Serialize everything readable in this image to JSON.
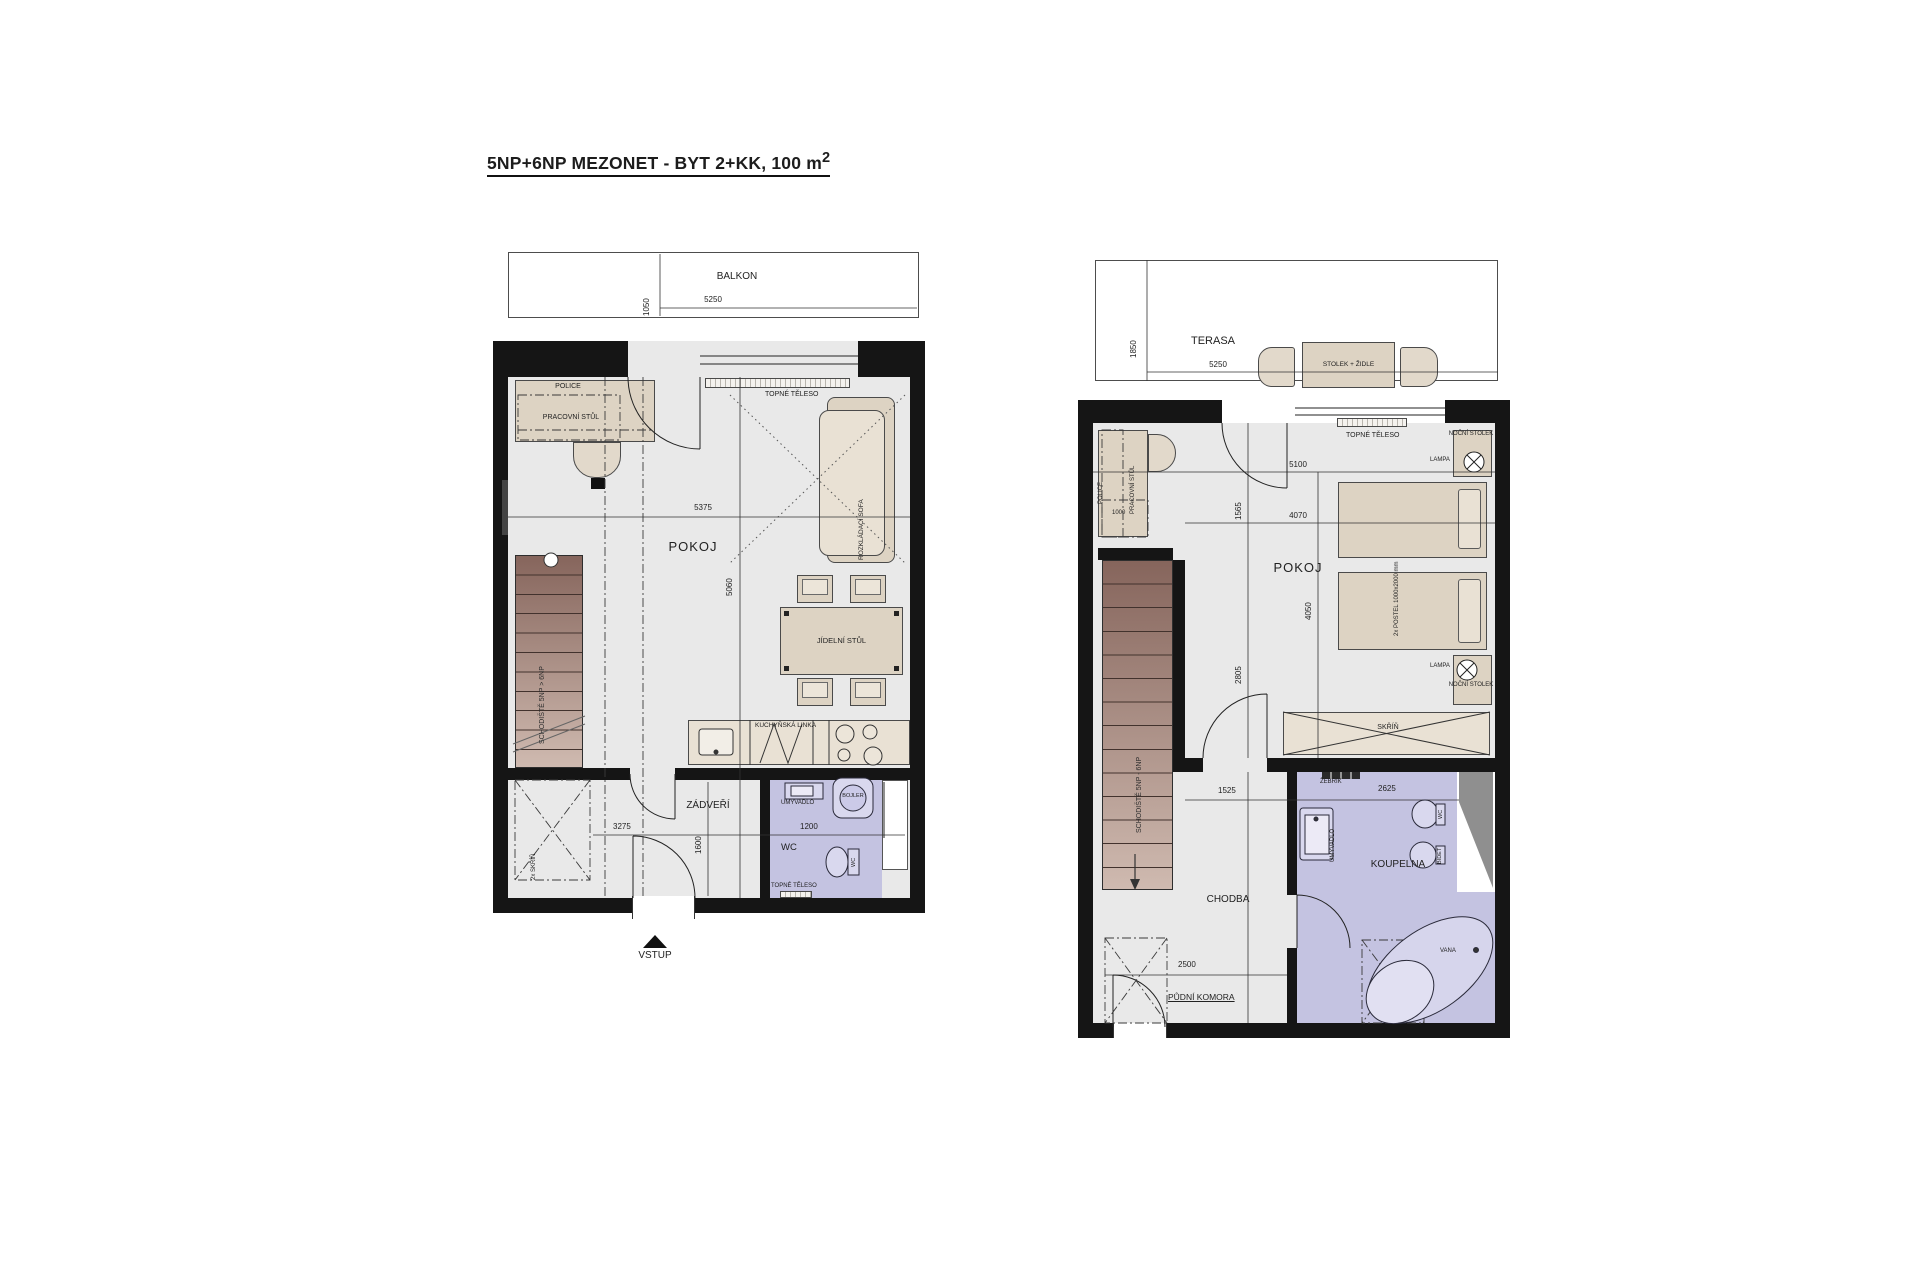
{
  "title": "5NP+6NP MEZONET - BYT 2+KK, 100 m",
  "title_sup": "2",
  "p5": {
    "balkon": "BALKON",
    "d1050": "1050",
    "d5250": "5250",
    "police": "POLICE",
    "stul": "PRACOVNÍ STŮL",
    "topne": "TOPNÉ TĚLESO",
    "sofa": "ROZKLÁDACÍ SOFA",
    "pokoj": "POKOJ",
    "d5375": "5375",
    "d5060": "5060",
    "jidelni": "JÍDELNÍ STŮL",
    "kuchyn": "KUCHYŇSKÁ LINKA",
    "schodiste": "SCHODIŠTĚ 5NP > 6NP",
    "zadveri": "ZÁDVEŘÍ",
    "d3275": "3275",
    "d1600": "1600",
    "skrin": "2x SKŘÍŇ",
    "wc": "WC",
    "d1200": "1200",
    "umyvadlo": "UMYVADLO",
    "bojler": "BOJLER",
    "wc2": "WC",
    "topne2": "TOPNÉ TĚLESO",
    "vstup": "VSTUP"
  },
  "p6": {
    "terasa": "TERASA",
    "d1850": "1850",
    "d5250": "5250",
    "stolek": "STOLEK + ŽIDLE",
    "police": "POLICE",
    "stul": "PRACOVNÍ STŮL",
    "d1000": "1000",
    "topne": "TOPNÉ TĚLESO",
    "nocni1": "NOČNÍ STOLEK",
    "lampa1": "LAMPA",
    "d5100": "5100",
    "d1565": "1565",
    "d4070": "4070",
    "d4050": "4050",
    "d2805": "2805",
    "pokoj": "POKOJ",
    "postel": "2x POSTEL 1000x2000 mm",
    "lampa2": "LAMPA",
    "nocni2": "NOČNÍ STOLEK",
    "skrin": "SKŘÍŇ",
    "zebrik": "ŽEBŘÍK",
    "d1525": "1525",
    "d2625": "2625",
    "umyvadlo": "UMYVADLO",
    "wc": "WC",
    "bidet": "BIDET",
    "koupelna": "KOUPELNA",
    "vana": "VANA",
    "chodba": "CHODBA",
    "komora": "PŮDNÍ KOMORA",
    "d2500": "2500",
    "schodiste": "SCHODIŠTĚ 5NP - 6NP"
  },
  "colors": {
    "wall": "#151515",
    "floor": "#e9e9e9",
    "bath": "#c4c3e1",
    "stair_dark": "#86655c",
    "stair_light": "#cfbab0",
    "furniture": "#ddd3c3",
    "furniture_light": "#e9e1d4"
  }
}
